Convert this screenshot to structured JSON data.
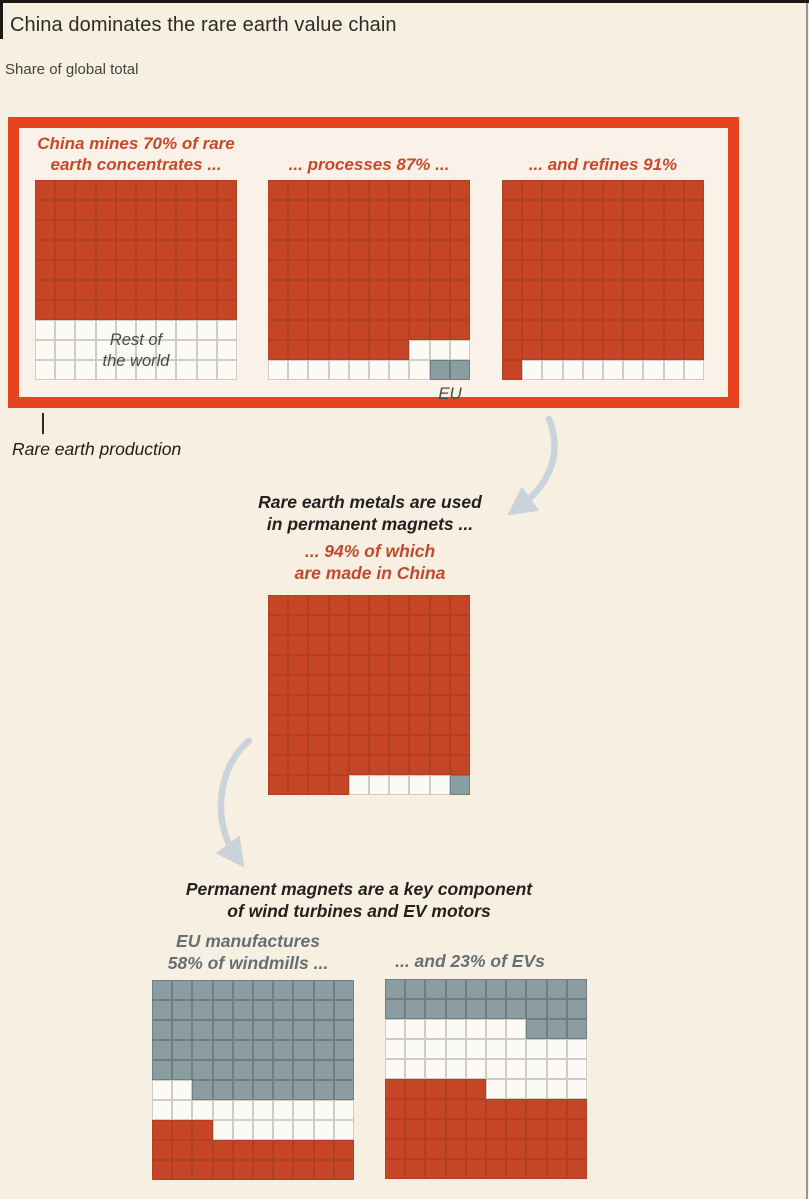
{
  "header": {
    "title": "China dominates the rare earth value chain",
    "subtitle": "Share of global total"
  },
  "colors": {
    "background": "#f8efe3",
    "highlight_box_border": "#e8431f",
    "china_red": "#c64527",
    "rest_of_world_white": "#fcfaf4",
    "eu_gray": "#8b9da1",
    "red_text": "#c8482a",
    "gray_text": "#686f72",
    "arrow": "#c9d3d9"
  },
  "annotations": {
    "production_label": "Rare earth production",
    "rest_of_world": [
      "Rest of",
      "the world"
    ],
    "eu": "EU",
    "magnets_intro": [
      "Rare earth metals are used",
      "in permanent magnets ..."
    ],
    "magnets_china": [
      "... 94% of which",
      "are made in China"
    ],
    "magnets_usage": [
      "Permanent magnets are a key component",
      "of wind turbines and EV motors"
    ],
    "windmills_heading": [
      "EU manufactures",
      "58% of windmills ..."
    ],
    "evs_heading": [
      "... and 23% of EVs"
    ]
  },
  "chart_data": {
    "type": "waffle",
    "unit": "1 cell = 1% of global total",
    "grid": "10x10",
    "color_legend": {
      "red": "China",
      "white": "Rest of the world",
      "gray": "EU"
    },
    "charts": [
      {
        "id": "mining",
        "heading": [
          "China mines 70% of rare",
          "earth concentrates ..."
        ],
        "values": {
          "China": 70,
          "Rest of the world": 30
        },
        "rows": [
          "RRRRRRRRRR",
          "RRRRRRRRRR",
          "RRRRRRRRRR",
          "RRRRRRRRRR",
          "RRRRRRRRRR",
          "RRRRRRRRRR",
          "RRRRRRRRRR",
          "WWWWWWWWWW",
          "WWWWWWWWWW",
          "WWWWWWWWWW"
        ]
      },
      {
        "id": "processing",
        "heading": [
          "... processes 87% ..."
        ],
        "values": {
          "China": 87,
          "Rest of the world": 11,
          "EU": 2
        },
        "rows": [
          "RRRRRRRRRR",
          "RRRRRRRRRR",
          "RRRRRRRRRR",
          "RRRRRRRRRR",
          "RRRRRRRRRR",
          "RRRRRRRRRR",
          "RRRRRRRRRR",
          "RRRRRRRRRR",
          "RRRRRRRWWW",
          "WWWWWWWWGG"
        ]
      },
      {
        "id": "refining",
        "heading": [
          "... and refines 91%"
        ],
        "values": {
          "China": 91,
          "Rest of the world": 9
        },
        "rows": [
          "RRRRRRRRRR",
          "RRRRRRRRRR",
          "RRRRRRRRRR",
          "RRRRRRRRRR",
          "RRRRRRRRRR",
          "RRRRRRRRRR",
          "RRRRRRRRRR",
          "RRRRRRRRRR",
          "RRRRRRRRRR",
          "RWWWWWWWWW"
        ]
      },
      {
        "id": "magnets",
        "heading": [],
        "values": {
          "China": 94,
          "Rest of the world": 5,
          "EU": 1
        },
        "rows": [
          "RRRRRRRRRR",
          "RRRRRRRRRR",
          "RRRRRRRRRR",
          "RRRRRRRRRR",
          "RRRRRRRRRR",
          "RRRRRRRRRR",
          "RRRRRRRRRR",
          "RRRRRRRRRR",
          "RRRRRRRRRR",
          "RRRRWWWWWG"
        ]
      },
      {
        "id": "windmills",
        "heading": [],
        "values": {
          "EU": 58,
          "Rest of the world": 19,
          "China": 23
        },
        "rows": [
          "GGGGGGGGGG",
          "GGGGGGGGGG",
          "GGGGGGGGGG",
          "GGGGGGGGGG",
          "GGGGGGGGGG",
          "WWGGGGGGGG",
          "WWWWWWWWWW",
          "RRRWWWWWWW",
          "RRRRRRRRRR",
          "RRRRRRRRRR"
        ]
      },
      {
        "id": "evs",
        "heading": [],
        "values": {
          "EU": 23,
          "Rest of the world": 32,
          "China": 45
        },
        "rows": [
          "GGGGGGGGGG",
          "GGGGGGGGGG",
          "WWWWWWWGGG",
          "WWWWWWWWWW",
          "WWWWWWWWWW",
          "RRRRRWWWWW",
          "RRRRRRRRRR",
          "RRRRRRRRRR",
          "RRRRRRRRRR",
          "RRRRRRRRRR"
        ]
      }
    ]
  }
}
